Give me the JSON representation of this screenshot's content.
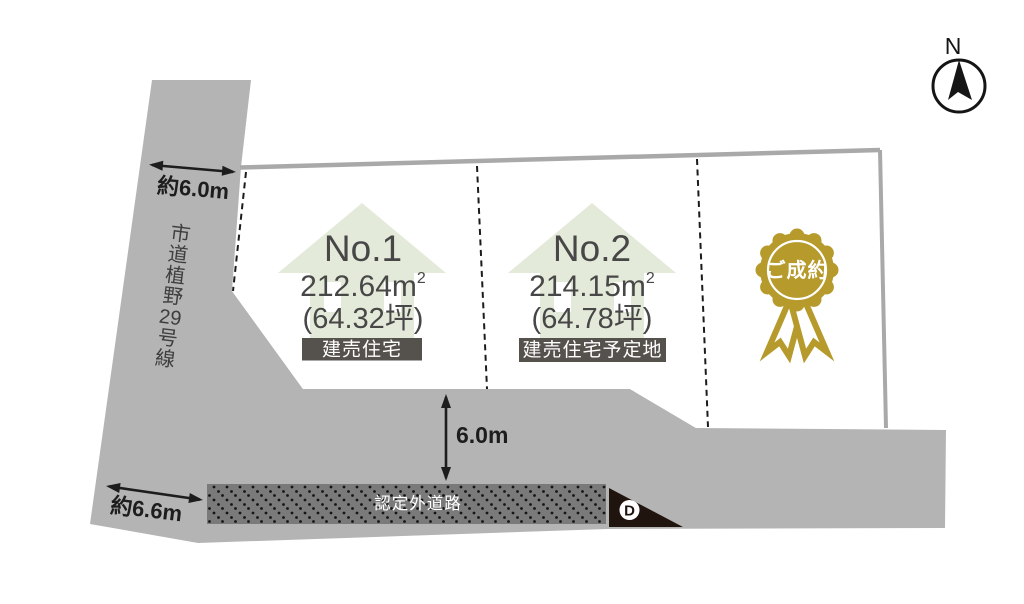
{
  "compass": {
    "north_label": "N"
  },
  "roads": {
    "main_road_name": "市道植野29号線",
    "main_road_name_chars": [
      "市",
      "道",
      "植",
      "野",
      "29",
      "号",
      "線"
    ],
    "unofficial_road_label": "認定外道路",
    "corner_marker_label": "D"
  },
  "dimensions": {
    "upper_road_width": "約6.0m",
    "lower_road_width": "約6.6m",
    "front_road_width": "6.0m"
  },
  "lots": [
    {
      "id": "No.1",
      "area_value": "212.64",
      "area_unit_base": "m",
      "area_unit_sup": "2",
      "area_tsubo": "(64.32坪)",
      "label": "建売住宅"
    },
    {
      "id": "No.2",
      "area_value": "214.15",
      "area_unit_base": "m",
      "area_unit_sup": "2",
      "area_tsubo": "(64.78坪)",
      "label": "建売住宅予定地"
    },
    {
      "status_badge": "ご成約"
    }
  ],
  "colors": {
    "road_fill": "#b4b4b4",
    "lot_fill": "#ffffff",
    "lot_border": "#a9a9a9",
    "house_icon_fill": "#e4ead9",
    "type_badge_bg": "#55514c",
    "unofficial_road_fill": "#7a7a7a",
    "corner_marker_bg": "#20150e",
    "sold_badge_gold": "#b69a2b",
    "text_dark": "#474747",
    "dimension_text": "#1d1d1d"
  }
}
